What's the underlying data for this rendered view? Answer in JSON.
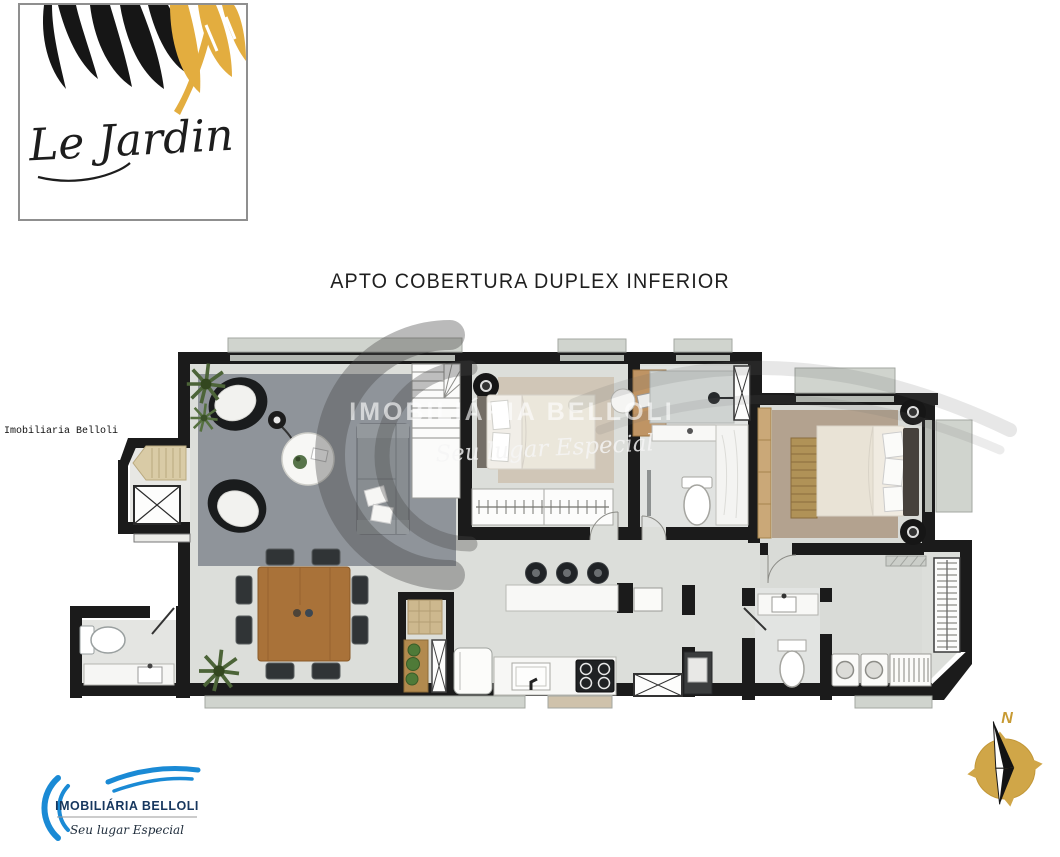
{
  "brand_card": {
    "script_name": "Le Jardin"
  },
  "plan_title": {
    "text": "APTO COBERTURA DUPLEX INFERIOR"
  },
  "side_watermark": {
    "text": "Imobiliaria Belloli"
  },
  "center_watermark": {
    "name": "IMOBILIÁRIA BELLOLI",
    "tagline": "Seu lugar Especial"
  },
  "agency_logo": {
    "name": "IMOBILIÁRIA BELLOLI",
    "tagline": "Seu lugar Especial"
  },
  "compass": {
    "north_label": "N"
  },
  "palette": {
    "wall": "#1b1b1b",
    "floor": "#dcdeda",
    "living_rug": "#8f949a",
    "master_rug": "#b3a28f",
    "bedroom_rug": "#d0c6b7",
    "wood": "#a97239",
    "leaf_gold": "#e3ad3f",
    "logo_blue": "#1a8ad5",
    "logo_navy": "#17375e",
    "compass_gold": "#d0a648"
  }
}
